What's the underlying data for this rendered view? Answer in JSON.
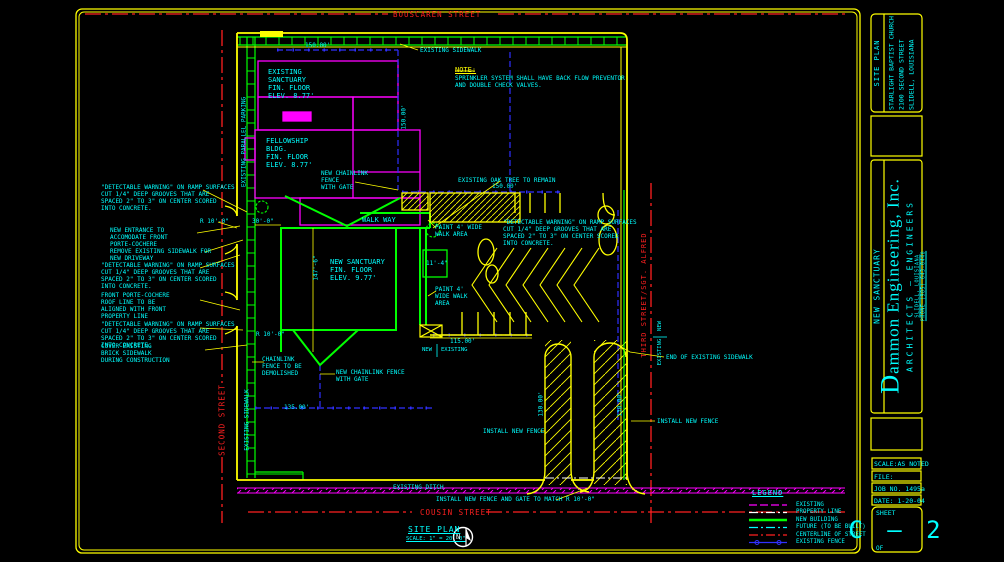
{
  "palette": {
    "yellow": "#ffff00",
    "cyan": "#00ffff",
    "magenta": "#ff00ff",
    "green": "#00ff00",
    "red": "#ff2020",
    "blue": "#3030ff",
    "white": "#ffffff",
    "background": "#000000"
  },
  "streets": {
    "top": "BOUSCAREN STREET",
    "left": "SECOND STREET",
    "right": "THIRD STREET/SGT. ALFRED",
    "bottom": "COUSIN STREET"
  },
  "site_title": {
    "label": "SITE PLAN",
    "scale": "SCALE: 1\" = 20'-0\"",
    "north_letter": "N"
  },
  "note": {
    "heading": "NOTE:",
    "body": "SPRINKLER SYSTEM SHALL HAVE BACK FLOW PREVENTOR\nAND DOUBLE CHECK VALVES."
  },
  "buildings": {
    "existing_sanctuary": "EXISTING\nSANCTUARY\nFIN. FLOOR\nELEV. 8.77'",
    "fellowship": "FELLOWSHIP\nBLDG.\nFIN. FLOOR\nELEV. 8.77'",
    "new_sanctuary": "NEW SANCTUARY\nFIN. FLOOR\nELEV. 9.77'",
    "walkway": "WALK WAY"
  },
  "annotations": {
    "detectable_warning": "\"DETECTABLE WARNING\" ON RAMP SURFACES\nCUT 1/4\" DEEP GROOVES THAT ARE\nSPACED 2\" TO 3\" ON CENTER SCORED\nINTO CONCRETE.",
    "new_entrance": "NEW ENTRANCE TO\nACCOMODATE FRONT\nPORTE-COCHERE",
    "remove_sidewalk": "REMOVE EXISTING SIDEWALK FOR\nNEW DRIVEWAY",
    "porte_cochere": "FRONT PORTE-COCHERE\nROOF LINE TO BE\nALIGNED WITH FRONT\nPROPERTY LINE",
    "cover_sidewalk": "COVER EXISTING\nBRICK SIDEWALK\nDURING CONSTRUCTION",
    "chainlink_demolished": "CHAINLINK\nFENCE TO BE\nDEMOLISHED",
    "new_chainlink_gate": "NEW CHAINLINK\nFENCE\nWITH GATE",
    "new_chainlink_gate2": "NEW CHAINLINK FENCE\nWITH GATE",
    "oak_tree": "EXISTING OAK TREE TO REMAIN",
    "paint_walk": "PAINT 4' WIDE\nWALK AREA",
    "paint_walk2": "PAINT 4'\nWIDE WALK\nAREA",
    "existing_sidewalk": "EXISTING SIDEWALK",
    "end_existing_sidewalk": "END OF EXISTING SIDEWALK",
    "install_new_fence": "INSTALL NEW FENCE",
    "install_gate": "INSTALL NEW FENCE AND GATE TO MATCH",
    "existing_ditch": "EXISTING DITCH",
    "existing_parallel_parking": "EXISTING PARALLEL PARKING",
    "marker_new": "NEW",
    "marker_existing": "EXISTING"
  },
  "dimensions": {
    "top_width": "150.00'",
    "fence_north": "150.00'",
    "west_side": "150.00'",
    "south_parking": "115.00'",
    "south_width": "135.00'",
    "wing_width": "30'-0\"",
    "building_depth": "147'-6\"",
    "walk_width": "11'-4\"",
    "radius": "R 10'-0\"",
    "drive_west": "130.00'",
    "drive_east": "130.00'"
  },
  "legend": {
    "title": "LEGEND",
    "items": [
      {
        "label": "EXISTING",
        "color": "#ff00ff",
        "style": "dashed"
      },
      {
        "label": "PROPERTY LINE",
        "color": "#ffffff",
        "style": "dash-dot"
      },
      {
        "label": "NEW BUILDING",
        "color": "#00ff00",
        "style": "solid"
      },
      {
        "label": "FUTURE (TO BE BUILT)",
        "color": "#00ffff",
        "style": "dash-dot"
      },
      {
        "label": "CENTERLINE OF STREET",
        "color": "#ff2020",
        "style": "dash-dot"
      },
      {
        "label": "EXISTING FENCE",
        "color": "#3030ff",
        "style": "line-with-posts"
      }
    ]
  },
  "titleblock": {
    "sheet_title_vertical": "SITE PLAN",
    "project": {
      "line1": "STARLIGHT BAPTIST CHURCH",
      "line2": "2100 SECOND STREET",
      "line3": "SLIDELL, LOUISIANA"
    },
    "project_vertical": "NEW SANCTUARY",
    "firm": {
      "name": "Dammon Engineering, Inc.",
      "subtitle": "ARCHITECTS — ENGINEERS",
      "address": "SLIDELL, LOUISIANA",
      "phone": "PHONE (985) 643-0448"
    },
    "scale": "SCALE:AS NOTED",
    "file": "FILE:",
    "job": "JOB NO. 1495a",
    "date": "DATE: 1-20-04",
    "sheet_label": "SHEET",
    "sheet_number": "C — 2",
    "of_label": "OF"
  }
}
